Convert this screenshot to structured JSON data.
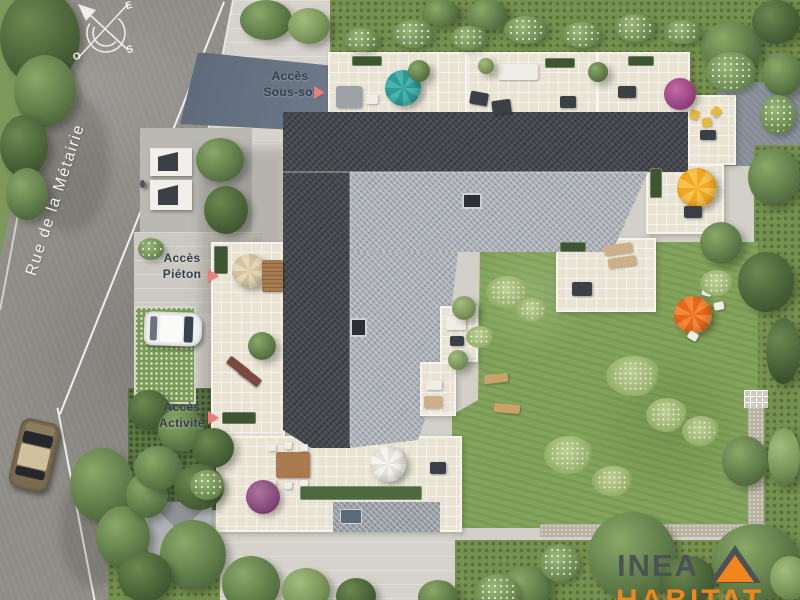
{
  "street": {
    "name": "Rue de la Métairie"
  },
  "compass": {
    "n": "N",
    "e": "E",
    "s": "S",
    "o": "O"
  },
  "labels": {
    "sous_sol": {
      "line1": "Accès",
      "line2": "Sous-sol"
    },
    "pieton": {
      "line1": "Accès",
      "line2": "Piéton"
    },
    "activite": {
      "line1": "Accès",
      "line2": "Activité"
    }
  },
  "icons": {
    "access_arrow": "▶"
  },
  "logo": {
    "name": "INEA",
    "tagline": "HABITAT"
  },
  "colors": {
    "arrow": "#ee7c7c",
    "logo_orange": "#f0861c",
    "logo_gray": "#4d5257",
    "roof_dark": "#45484d",
    "roof_light": "#a9aeb5",
    "lawn": "#83a45c",
    "teal": "#2f9e99",
    "yellow": "#f2a81f",
    "orange_parasol": "#e8681c"
  }
}
